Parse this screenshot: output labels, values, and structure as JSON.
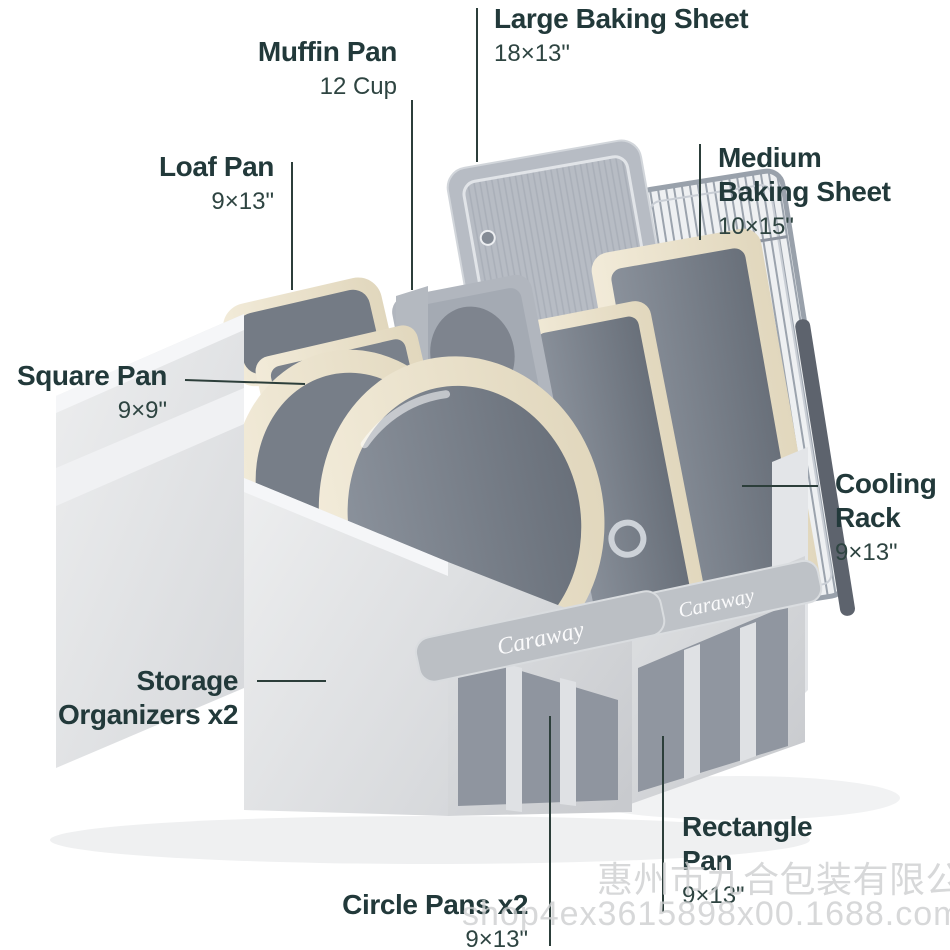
{
  "image": {
    "type": "annotated-product-photo",
    "background": "#ffffff"
  },
  "brand": {
    "logo_text": "Caraway"
  },
  "palette": {
    "label_text": "#22393a",
    "dims_text": "#2e4441",
    "leader_line": "#2c3e3a",
    "bin_fabric": "#dcdee1",
    "cream_bakeware": "#e9e0c9",
    "pan_interior_gray": "#79808a",
    "metal_gray": "#b7bcc4"
  },
  "labels": {
    "large_baking_sheet": {
      "title": "Large Baking Sheet",
      "dims": "18×13\""
    },
    "muffin_pan": {
      "title": "Muffin Pan",
      "dims": "12 Cup"
    },
    "loaf_pan": {
      "title": "Loaf Pan",
      "dims": "9×13\""
    },
    "medium_baking_sheet": {
      "line1": "Medium",
      "line2": "Baking Sheet",
      "dims": "10×15\""
    },
    "square_pan": {
      "title": "Square Pan",
      "dims": "9×9\""
    },
    "cooling_rack": {
      "line1": "Cooling",
      "line2": "Rack",
      "dims": "9×13\""
    },
    "storage_organizers": {
      "line1": "Storage",
      "line2": "Organizers x2"
    },
    "rectangle_pan": {
      "line1": "Rectangle",
      "line2": "Pan",
      "dims": "9×13\""
    },
    "circle_pans": {
      "title": "Circle Pans x2",
      "dims": "9×13\""
    }
  },
  "watermark": {
    "line1": "惠州市九合包装有限公司",
    "line2": "shop4ex3615898x00.1688.com"
  }
}
